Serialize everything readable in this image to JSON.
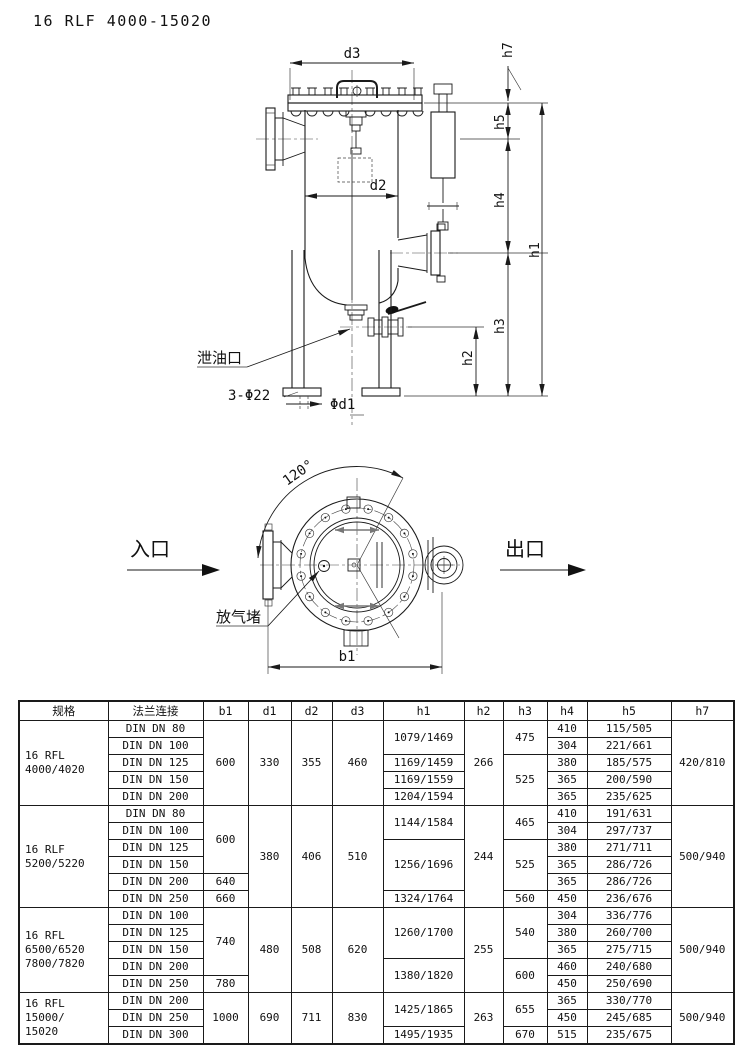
{
  "title": "16 RLF 4000-15020",
  "front_view": {
    "dims": {
      "d3": "d3",
      "d2": "d2",
      "h1": "h1",
      "h2": "h2",
      "h3": "h3",
      "h4": "h4",
      "h5": "h5",
      "h7": "h7"
    },
    "drain_label": "泄油口",
    "foot_holes_label": "3-Φ22",
    "bolt_circle_label": "Φd1"
  },
  "top_view": {
    "angle_label": "120°",
    "inlet_label": "入口",
    "outlet_label": "出口",
    "vent_label": "放气堵",
    "width_label": "b1"
  },
  "table": {
    "headers": [
      "规格",
      "法兰连接",
      "b1",
      "d1",
      "d2",
      "d3",
      "h1",
      "h2",
      "h3",
      "h4",
      "h5",
      "h7"
    ],
    "col_widths": [
      89,
      95,
      45,
      43,
      41,
      51,
      81,
      39,
      44,
      40,
      84,
      63
    ],
    "rows": [
      [
        {
          "t": "16 RFL\n4000/4020",
          "rs": 5,
          "c": "spec"
        },
        {
          "t": "DIN DN 80"
        },
        {
          "t": "600",
          "rs": 5
        },
        {
          "t": "330",
          "rs": 5
        },
        {
          "t": "355",
          "rs": 5
        },
        {
          "t": "460",
          "rs": 5
        },
        {
          "t": "1079/1469",
          "rs": 2
        },
        {
          "t": "266",
          "rs": 5
        },
        {
          "t": "475",
          "rs": 2
        },
        {
          "t": "410"
        },
        {
          "t": "115/505"
        },
        {
          "t": "420/810",
          "rs": 5
        }
      ],
      [
        {
          "t": "DIN DN 100"
        },
        {
          "t": "304"
        },
        {
          "t": "221/661"
        }
      ],
      [
        {
          "t": "DIN DN 125"
        },
        {
          "t": "1169/1459"
        },
        {
          "t": "525",
          "rs": 3
        },
        {
          "t": "380"
        },
        {
          "t": "185/575"
        }
      ],
      [
        {
          "t": "DIN DN 150"
        },
        {
          "t": "1169/1559"
        },
        {
          "t": "365"
        },
        {
          "t": "200/590"
        }
      ],
      [
        {
          "t": "DIN DN 200"
        },
        {
          "t": "1204/1594"
        },
        {
          "t": "365"
        },
        {
          "t": "235/625"
        }
      ],
      [
        {
          "t": "16 RLF\n5200/5220",
          "rs": 6,
          "c": "spec"
        },
        {
          "t": "DIN DN 80"
        },
        {
          "t": "600",
          "rs": 4
        },
        {
          "t": "380",
          "rs": 6
        },
        {
          "t": "406",
          "rs": 6
        },
        {
          "t": "510",
          "rs": 6
        },
        {
          "t": "1144/1584",
          "rs": 2
        },
        {
          "t": "244",
          "rs": 6
        },
        {
          "t": "465",
          "rs": 2
        },
        {
          "t": "410"
        },
        {
          "t": "191/631"
        },
        {
          "t": "500/940",
          "rs": 6
        }
      ],
      [
        {
          "t": "DIN DN 100"
        },
        {
          "t": "304"
        },
        {
          "t": "297/737"
        }
      ],
      [
        {
          "t": "DIN DN 125"
        },
        {
          "t": "1256/1696",
          "rs": 3
        },
        {
          "t": "525",
          "rs": 3
        },
        {
          "t": "380"
        },
        {
          "t": "271/711"
        }
      ],
      [
        {
          "t": "DIN DN 150"
        },
        {
          "t": "365"
        },
        {
          "t": "286/726"
        }
      ],
      [
        {
          "t": "DIN DN 200"
        },
        {
          "t": "640"
        },
        {
          "t": "365"
        },
        {
          "t": "286/726"
        }
      ],
      [
        {
          "t": "DIN DN 250"
        },
        {
          "t": "660"
        },
        {
          "t": "1324/1764"
        },
        {
          "t": "560"
        },
        {
          "t": "450"
        },
        {
          "t": "236/676"
        }
      ],
      [
        {
          "t": "16 RFL\n6500/6520\n7800/7820",
          "rs": 5,
          "c": "spec"
        },
        {
          "t": "DIN DN 100"
        },
        {
          "t": "740",
          "rs": 4
        },
        {
          "t": "480",
          "rs": 5
        },
        {
          "t": "508",
          "rs": 5
        },
        {
          "t": "620",
          "rs": 5
        },
        {
          "t": "1260/1700",
          "rs": 3
        },
        {
          "t": "255",
          "rs": 5
        },
        {
          "t": "540",
          "rs": 3
        },
        {
          "t": "304"
        },
        {
          "t": "336/776"
        },
        {
          "t": "500/940",
          "rs": 5
        }
      ],
      [
        {
          "t": "DIN DN 125"
        },
        {
          "t": "380"
        },
        {
          "t": "260/700"
        }
      ],
      [
        {
          "t": "DIN DN 150"
        },
        {
          "t": "365"
        },
        {
          "t": "275/715"
        }
      ],
      [
        {
          "t": "DIN DN 200"
        },
        {
          "t": "1380/1820",
          "rs": 2
        },
        {
          "t": "600",
          "rs": 2
        },
        {
          "t": "460"
        },
        {
          "t": "240/680"
        }
      ],
      [
        {
          "t": "DIN DN 250"
        },
        {
          "t": "780"
        },
        {
          "t": "450"
        },
        {
          "t": "250/690"
        }
      ],
      [
        {
          "t": "16 RFL\n15000/\n15020",
          "rs": 3,
          "c": "spec"
        },
        {
          "t": "DIN DN 200"
        },
        {
          "t": "1000",
          "rs": 3
        },
        {
          "t": "690",
          "rs": 3
        },
        {
          "t": "711",
          "rs": 3
        },
        {
          "t": "830",
          "rs": 3
        },
        {
          "t": "1425/1865",
          "rs": 2
        },
        {
          "t": "263",
          "rs": 3
        },
        {
          "t": "655",
          "rs": 2
        },
        {
          "t": "365"
        },
        {
          "t": "330/770"
        },
        {
          "t": "500/940",
          "rs": 3
        }
      ],
      [
        {
          "t": "DIN DN 250"
        },
        {
          "t": "450"
        },
        {
          "t": "245/685"
        }
      ],
      [
        {
          "t": "DIN DN 300"
        },
        {
          "t": "1495/1935"
        },
        {
          "t": "670"
        },
        {
          "t": "515"
        },
        {
          "t": "235/675"
        }
      ]
    ]
  }
}
